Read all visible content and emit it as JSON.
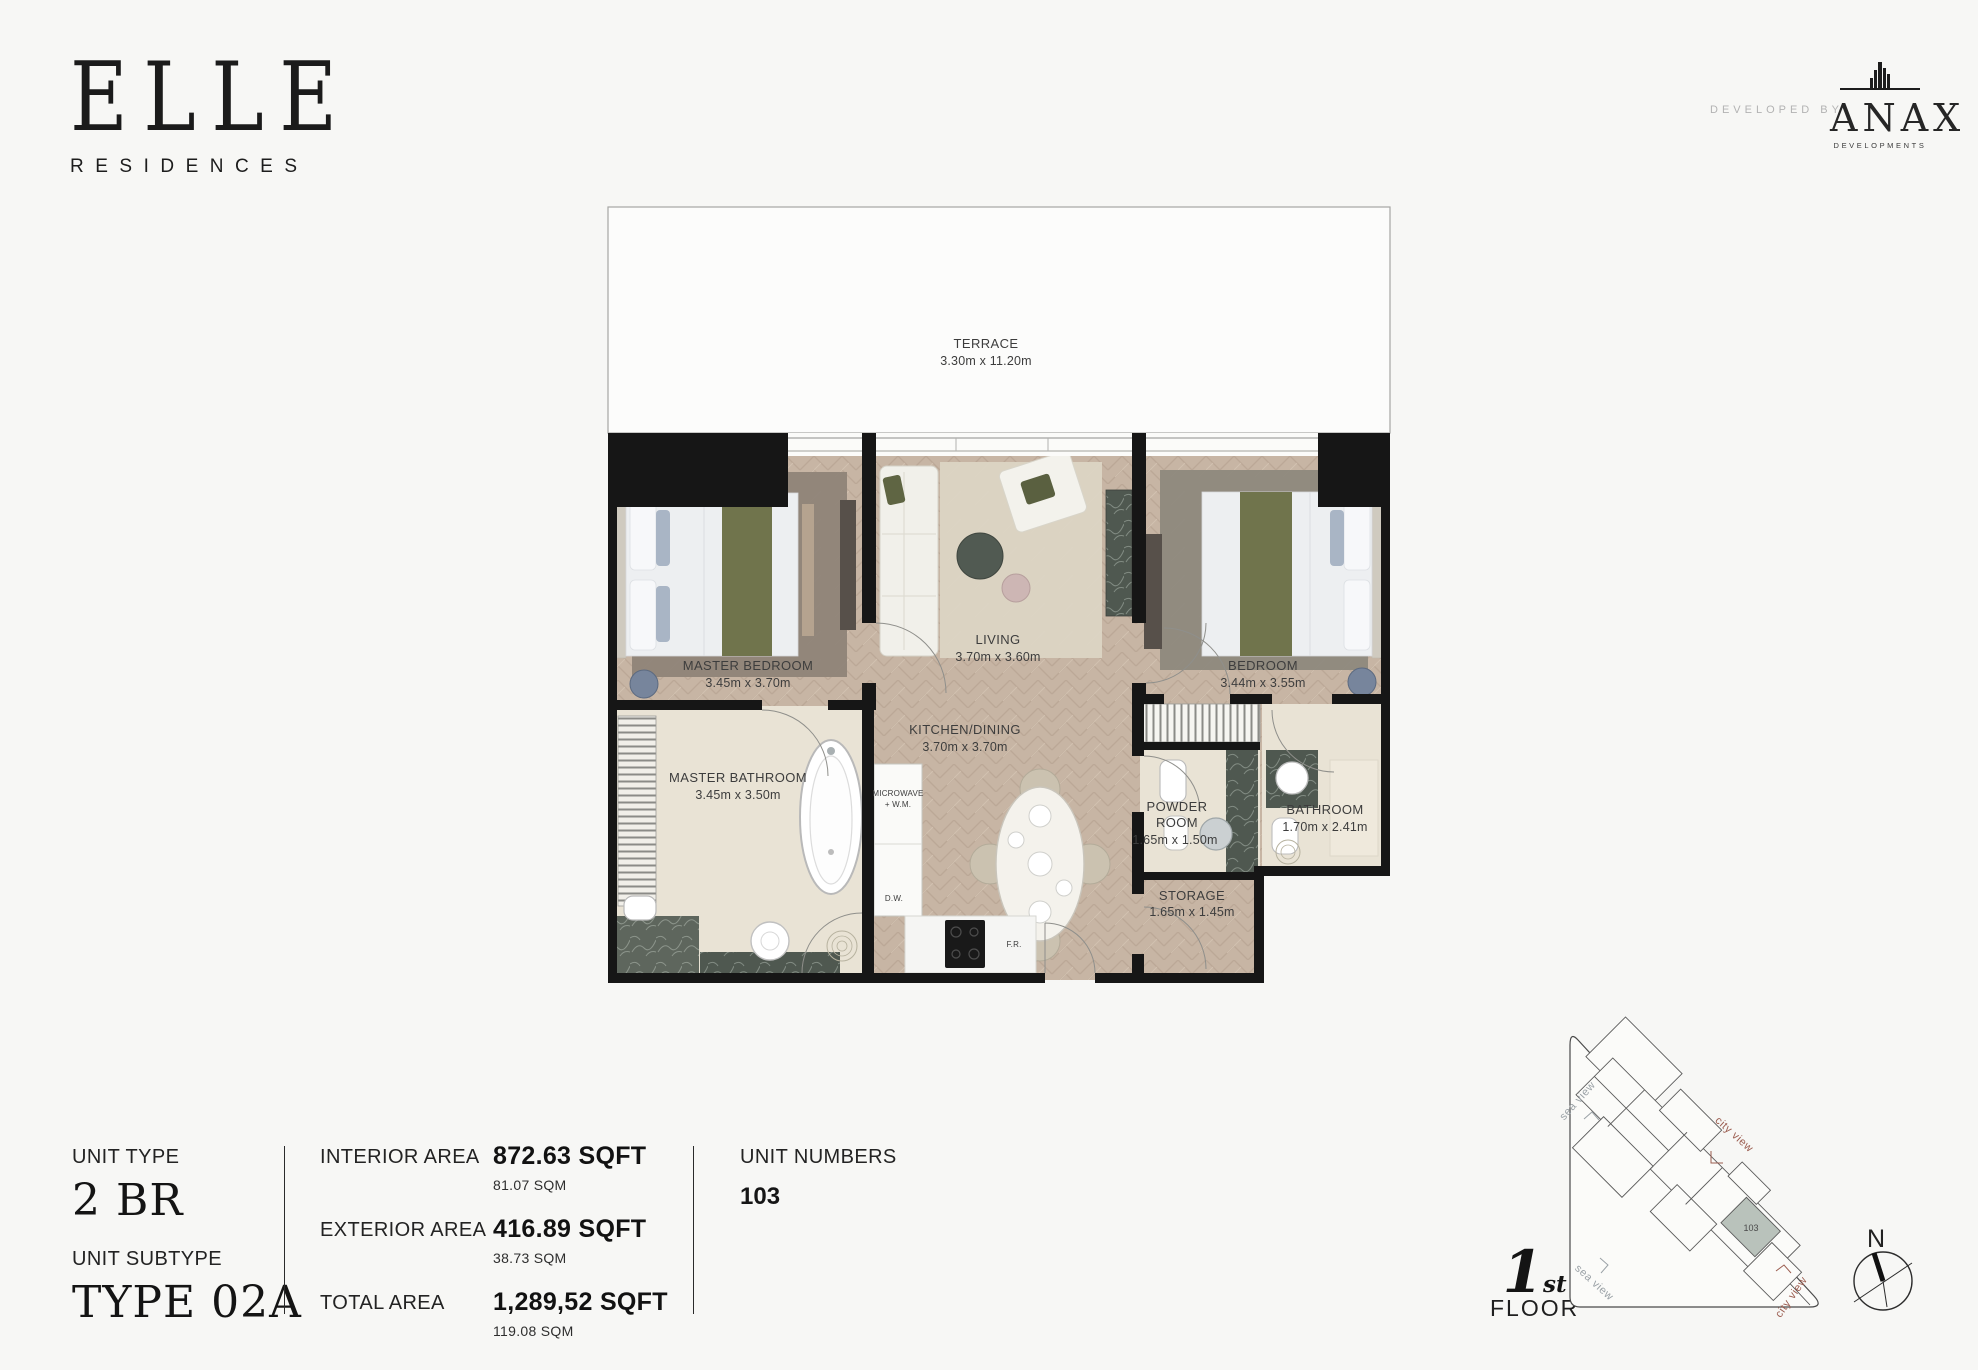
{
  "brand": {
    "name": "ELLE",
    "subtitle": "RESIDENCES",
    "developed_by": "DEVELOPED BY",
    "developer": "ANAX",
    "developer_sub": "DEVELOPMENTS"
  },
  "plan": {
    "terrace": {
      "name": "TERRACE",
      "dims": "3.30m x 11.20m"
    },
    "master_bedroom": {
      "name": "MASTER BEDROOM",
      "dims": "3.45m x 3.70m"
    },
    "living": {
      "name": "LIVING",
      "dims": "3.70m x 3.60m"
    },
    "bedroom": {
      "name": "BEDROOM",
      "dims": "3.44m x 3.55m"
    },
    "master_bathroom": {
      "name": "MASTER BATHROOM",
      "dims": "3.45m x 3.50m"
    },
    "kitchen": {
      "name": "KITCHEN/DINING",
      "dims": "3.70m x 3.70m"
    },
    "microwave": {
      "line1": "MICROWAVE",
      "line2": "+ W.M."
    },
    "powder": {
      "line1": "POWDER",
      "line2": "ROOM",
      "dims": "1.65m x 1.50m"
    },
    "bathroom": {
      "name": "BATHROOM",
      "dims": "1.70m x 2.41m"
    },
    "storage": {
      "name": "STORAGE",
      "dims": "1.65m x 1.45m"
    },
    "dw": "D.W.",
    "fr": "F.R."
  },
  "info": {
    "unit_type_label": "UNIT TYPE",
    "unit_type": "2 BR",
    "unit_subtype_label": "UNIT SUBTYPE",
    "unit_subtype": "TYPE 02A",
    "interior_label": "INTERIOR AREA",
    "interior_sqft": "872.63 SQFT",
    "interior_sqm": "81.07 SQM",
    "exterior_label": "EXTERIOR AREA",
    "exterior_sqft": "416.89 SQFT",
    "exterior_sqm": "38.73 SQM",
    "total_label": "TOTAL AREA",
    "total_sqft": "1,289,52 SQFT",
    "total_sqm": "119.08 SQM",
    "unit_numbers_label": "UNIT NUMBERS",
    "unit_numbers": "103"
  },
  "map": {
    "floor_num": "1",
    "floor_ord": "st",
    "floor_word": "FLOOR",
    "unit": "103",
    "sea_view": "sea view",
    "city_view": "city view",
    "north": "N",
    "colors": {
      "city": "#9b5d50",
      "sea": "#9aa1a6",
      "highlight": "#b9c2bb",
      "wall": "#161616",
      "wood_floor": "#c7b5a4",
      "stone_floor": "#e9e3d5"
    }
  }
}
